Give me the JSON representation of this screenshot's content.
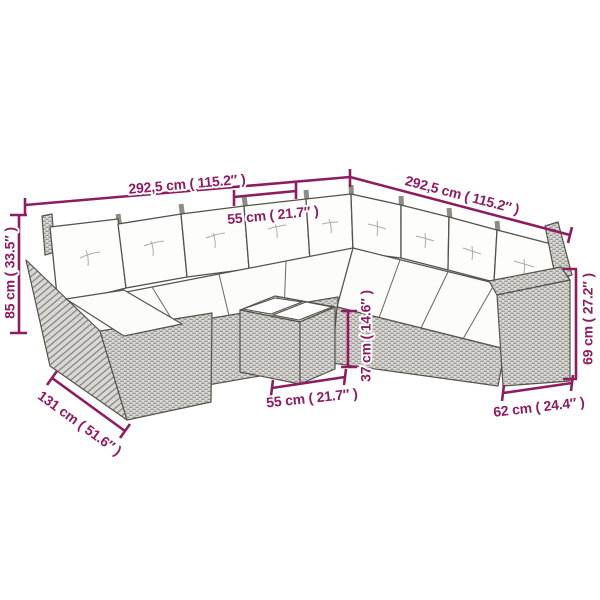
{
  "diagram": {
    "type": "product-dimension-diagram",
    "subject": "garden-lounge-set-line-drawing",
    "background": "#FFFFFF",
    "colors": {
      "dimension": "#8E1C60",
      "outline": "#55514B",
      "rattan_fill": "#DBDAD7",
      "rattan_weave": "#94918A",
      "cushion": "#FDFDFB"
    },
    "measurements": {
      "back_width_left": {
        "cm": "292,5",
        "inch": "115.2",
        "label": "292,5 cm ( 115.2″ )"
      },
      "back_width_right": {
        "cm": "292,5",
        "inch": "115.2",
        "label": "292,5 cm ( 115.2″ )"
      },
      "seat_module_width": {
        "cm": "55",
        "inch": "21.7",
        "label": "55 cm ( 21.7″ )"
      },
      "back_height": {
        "cm": "85",
        "inch": "33.5",
        "label": "85 cm ( 33.5″ )"
      },
      "chaise_depth": {
        "cm": "131",
        "inch": "51.6",
        "label": "131 cm ( 51.6″ )"
      },
      "table_height": {
        "cm": "37",
        "inch": "14.6",
        "label": "37 cm ( 14.6″ )"
      },
      "table_width": {
        "cm": "55",
        "inch": "21.7",
        "label": "55 cm ( 21.7″ )"
      },
      "armrest_height": {
        "cm": "69",
        "inch": "27.2",
        "label": "69 cm ( 27.2″ )"
      },
      "armrest_depth": {
        "cm": "62",
        "inch": "24.4",
        "label": "62 cm ( 24.4″ )"
      }
    }
  }
}
